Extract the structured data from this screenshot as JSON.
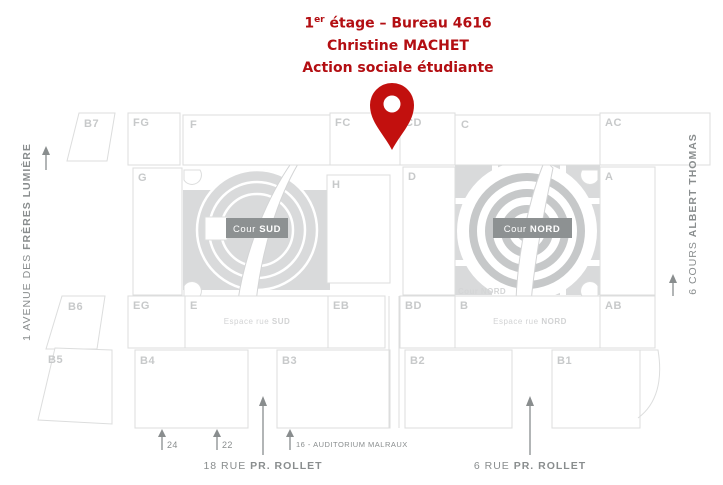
{
  "title": {
    "line1_num": "1",
    "line1_sup": "er",
    "line1_rest": " étage – Bureau 4616",
    "line2": "Christine MACHET",
    "line3": "Action sociale étudiante"
  },
  "colors": {
    "title_red": "#b30e12",
    "pin_red": "#c2100e",
    "block_outline": "#dcdddd",
    "block_label": "#c7c9ca",
    "street_text": "#898d8e",
    "badge_background": "#8d9192",
    "courtyard_gray": "#d9dadb"
  },
  "blocks": {
    "b7": "B7",
    "fg": "FG",
    "f": "F",
    "fc": "FC",
    "cd": "CD",
    "c": "C",
    "ac": "AC",
    "g": "G",
    "h": "H",
    "d": "D",
    "a": "A",
    "b6": "B6",
    "eg": "EG",
    "e": "E",
    "eb": "EB",
    "bd": "BD",
    "b": "B",
    "ab": "AB",
    "b5": "B5",
    "b4": "B4",
    "b3": "B3",
    "b2": "B2",
    "b1": "B1"
  },
  "courtyards": {
    "sud_badge": {
      "regular": "Cour ",
      "bold": "SUD"
    },
    "nord_badge": {
      "regular": "Cour ",
      "bold": "NORD"
    },
    "nord_small": {
      "regular": "Cour ",
      "bold": "NORD"
    }
  },
  "espaces": {
    "sud": {
      "regular": "Espace rue ",
      "bold": "SUD"
    },
    "nord": {
      "regular": "Espace rue ",
      "bold": "NORD"
    }
  },
  "streets": {
    "left": {
      "regular": "1 AVENUE DES ",
      "bold": "FRÈRES LUMIÈRE"
    },
    "right": {
      "regular": "6 COURS ",
      "bold": "ALBERT THOMAS"
    },
    "bottom_left": {
      "regular": "18 RUE ",
      "bold": "PR. ROLLET"
    },
    "bottom_right": {
      "regular": "6 RUE ",
      "bold": "PR. ROLLET"
    }
  },
  "entrances": {
    "e24": "24",
    "e22": "22",
    "e16": "16 - AUDITORIUM MALRAUX"
  }
}
